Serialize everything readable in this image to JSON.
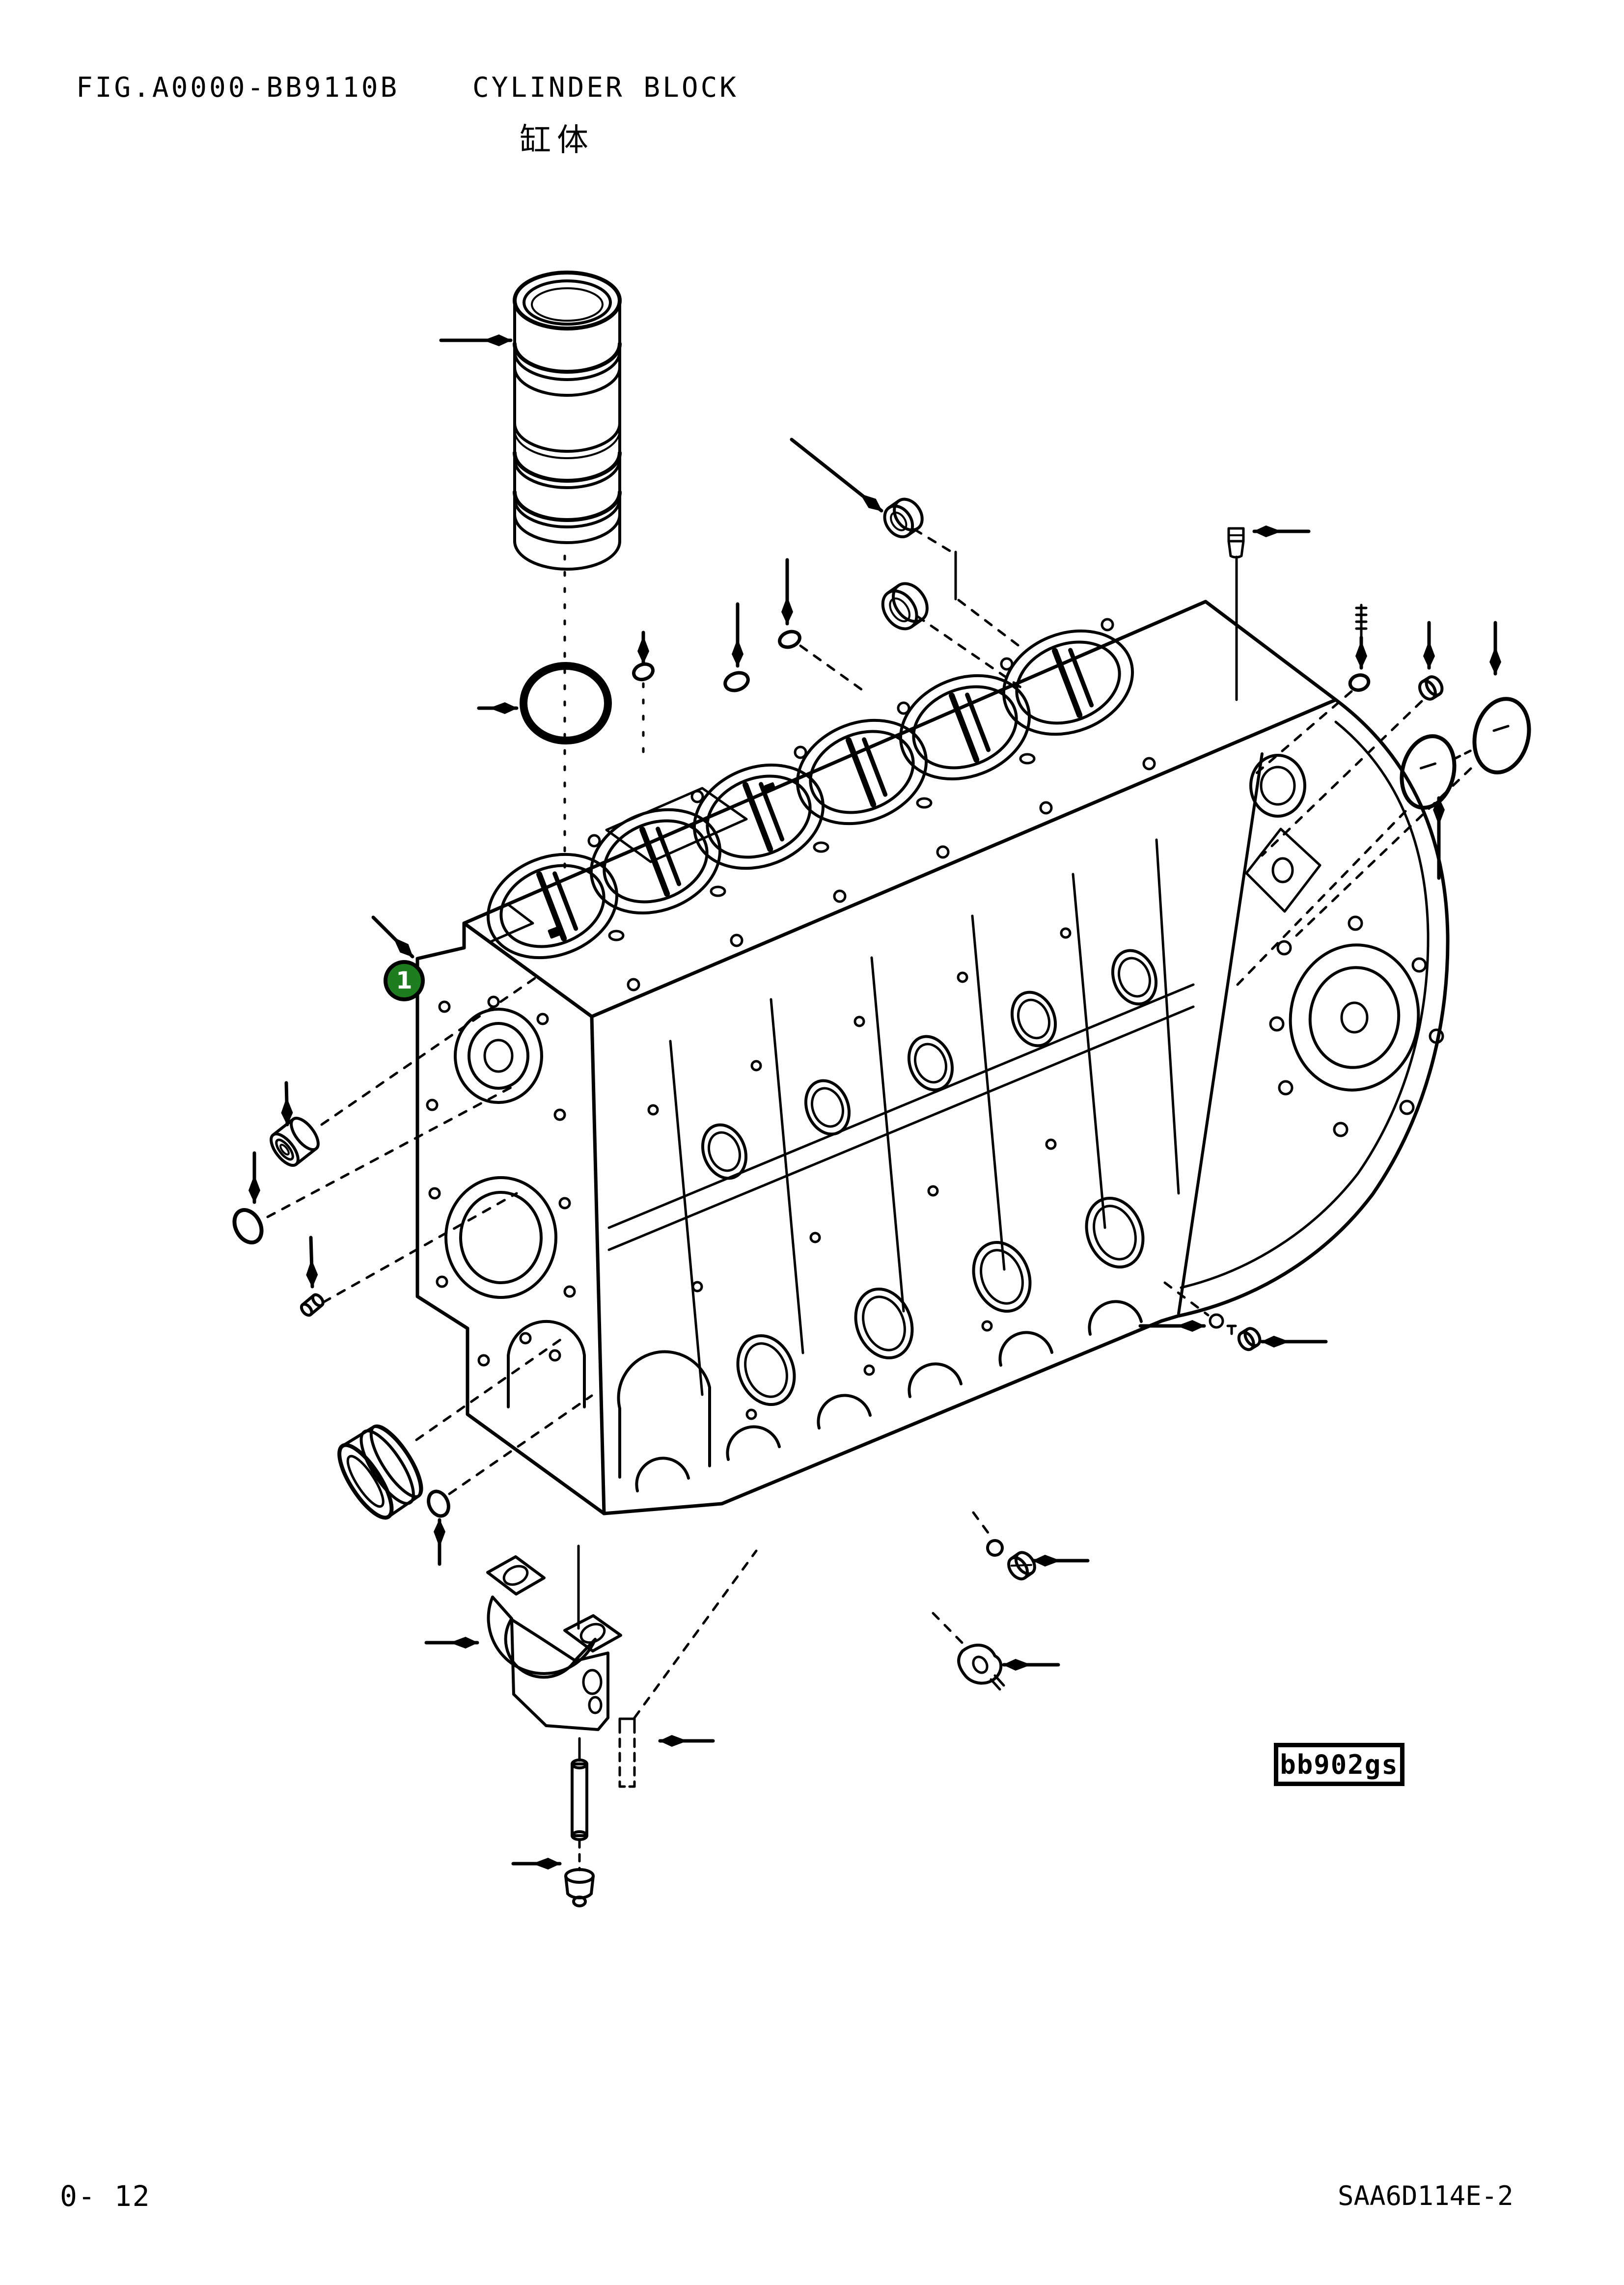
{
  "header": {
    "fig_label": "FIG.A0000-BB9110B",
    "title": "CYLINDER BLOCK",
    "title_local": "缸体"
  },
  "footer": {
    "page_number": "0- 12",
    "model_code": "SAA6D114E-2"
  },
  "diagram": {
    "balloon_1": "1",
    "code_label": "bb902gs",
    "balloon_color": "#1e7d1e",
    "line_color": "#000000",
    "paper_color": "#ffffff"
  }
}
